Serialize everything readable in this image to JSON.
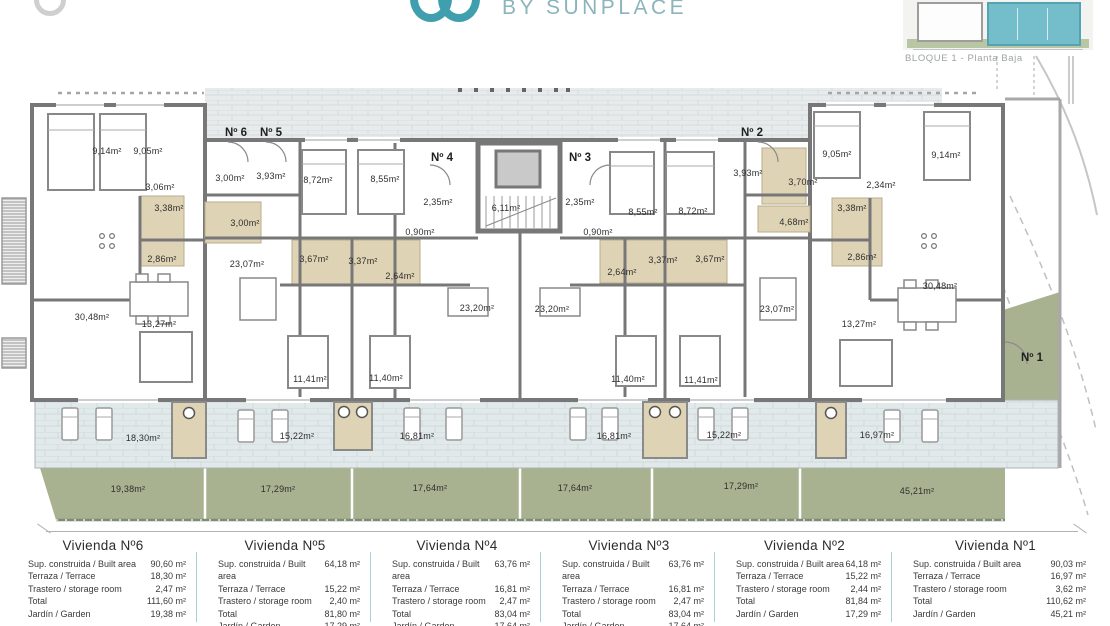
{
  "header": {
    "brand": "BY SUNPLACE",
    "caption": "BLOQUE 1 - Planta Baja"
  },
  "colors": {
    "accent_teal": "#3f9fae",
    "brand_text": "#8cb4bc",
    "wall_gray": "#777777",
    "bath_tan": "#ded3b4",
    "terrace_blue_gray": "#e2e9ea",
    "garden_green": "#a8b290",
    "table_separator": "#a9d2d6"
  },
  "plan": {
    "entrances": [
      {
        "t": "Nº 6",
        "x": 236,
        "y": 133
      },
      {
        "t": "Nº 5",
        "x": 271,
        "y": 133
      },
      {
        "t": "Nº 4",
        "x": 442,
        "y": 158
      },
      {
        "t": "Nº 3",
        "x": 580,
        "y": 158
      },
      {
        "t": "Nº 2",
        "x": 752,
        "y": 133
      },
      {
        "t": "Nº 1",
        "x": 1032,
        "y": 358
      }
    ],
    "rooms": [
      {
        "t": "9,14m²",
        "x": 107,
        "y": 151
      },
      {
        "t": "9,05m²",
        "x": 148,
        "y": 151
      },
      {
        "t": "3,06m²",
        "x": 160,
        "y": 187
      },
      {
        "t": "3,00m²",
        "x": 230,
        "y": 178
      },
      {
        "t": "3,93m²",
        "x": 271,
        "y": 176
      },
      {
        "t": "3,38m²",
        "x": 169,
        "y": 208
      },
      {
        "t": "3,00m²",
        "x": 245,
        "y": 223
      },
      {
        "t": "2,86m²",
        "x": 162,
        "y": 259
      },
      {
        "t": "23,07m²",
        "x": 247,
        "y": 264
      },
      {
        "t": "30,48m²",
        "x": 92,
        "y": 317
      },
      {
        "t": "13,27m²",
        "x": 159,
        "y": 324
      },
      {
        "t": "8,72m²",
        "x": 318,
        "y": 180
      },
      {
        "t": "8,55m²",
        "x": 385,
        "y": 179
      },
      {
        "t": "2,35m²",
        "x": 438,
        "y": 202
      },
      {
        "t": "6,11m²",
        "x": 506,
        "y": 208
      },
      {
        "t": "0,90m²",
        "x": 420,
        "y": 232
      },
      {
        "t": "3,67m²",
        "x": 314,
        "y": 259
      },
      {
        "t": "3,37m²",
        "x": 363,
        "y": 261
      },
      {
        "t": "2,64m²",
        "x": 400,
        "y": 276
      },
      {
        "t": "23,20m²",
        "x": 477,
        "y": 308
      },
      {
        "t": "23,20m²",
        "x": 552,
        "y": 309
      },
      {
        "t": "2,35m²",
        "x": 580,
        "y": 202
      },
      {
        "t": "0,90m²",
        "x": 598,
        "y": 232
      },
      {
        "t": "8,55m²",
        "x": 643,
        "y": 212
      },
      {
        "t": "8,72m²",
        "x": 693,
        "y": 211
      },
      {
        "t": "3,93m²",
        "x": 748,
        "y": 173
      },
      {
        "t": "3,70m²",
        "x": 803,
        "y": 182
      },
      {
        "t": "4,68m²",
        "x": 794,
        "y": 222
      },
      {
        "t": "2,64m²",
        "x": 622,
        "y": 272
      },
      {
        "t": "3,37m²",
        "x": 663,
        "y": 260
      },
      {
        "t": "3,67m²",
        "x": 710,
        "y": 259
      },
      {
        "t": "23,07m²",
        "x": 777,
        "y": 309
      },
      {
        "t": "13,27m²",
        "x": 859,
        "y": 324
      },
      {
        "t": "9,05m²",
        "x": 837,
        "y": 154
      },
      {
        "t": "9,14m²",
        "x": 946,
        "y": 155
      },
      {
        "t": "2,34m²",
        "x": 881,
        "y": 185
      },
      {
        "t": "3,38m²",
        "x": 852,
        "y": 208
      },
      {
        "t": "2,86m²",
        "x": 862,
        "y": 257
      },
      {
        "t": "30,48m²",
        "x": 940,
        "y": 286
      },
      {
        "t": "11,41m²",
        "x": 310,
        "y": 379
      },
      {
        "t": "11,40m²",
        "x": 386,
        "y": 378
      },
      {
        "t": "11,40m²",
        "x": 628,
        "y": 379
      },
      {
        "t": "11,41m²",
        "x": 701,
        "y": 380
      },
      {
        "t": "18,30m²",
        "x": 143,
        "y": 438
      },
      {
        "t": "15,22m²",
        "x": 297,
        "y": 436
      },
      {
        "t": "16,81m²",
        "x": 417,
        "y": 436
      },
      {
        "t": "16,81m²",
        "x": 614,
        "y": 436
      },
      {
        "t": "15,22m²",
        "x": 724,
        "y": 435
      },
      {
        "t": "16,97m²",
        "x": 877,
        "y": 435
      },
      {
        "t": "19,38m²",
        "x": 128,
        "y": 489
      },
      {
        "t": "17,29m²",
        "x": 278,
        "y": 489
      },
      {
        "t": "17,64m²",
        "x": 430,
        "y": 488
      },
      {
        "t": "17,64m²",
        "x": 575,
        "y": 488
      },
      {
        "t": "17,29m²",
        "x": 741,
        "y": 486
      },
      {
        "t": "45,21m²",
        "x": 917,
        "y": 491
      }
    ]
  },
  "table": {
    "units": [
      {
        "title": "Vivienda Nº6",
        "rows": [
          {
            "label": "Sup. construida / Built area",
            "value": "90,60 m²"
          },
          {
            "label": "Terraza / Terrace",
            "value": "18,30 m²"
          },
          {
            "label": "Trastero / storage room",
            "value": "2,47 m²"
          },
          {
            "label": "Total",
            "value": "111,60 m²"
          },
          {
            "label": "Jardín / Garden",
            "value": "19,38 m²"
          }
        ]
      },
      {
        "title": "Vivienda Nº5",
        "rows": [
          {
            "label": "Sup. construida / Built area",
            "value": "64,18 m²"
          },
          {
            "label": "Terraza / Terrace",
            "value": "15,22 m²"
          },
          {
            "label": "Trastero / storage room",
            "value": "2,40 m²"
          },
          {
            "label": "Total",
            "value": "81,80 m²"
          },
          {
            "label": "Jardín / Garden",
            "value": "17,29 m²"
          }
        ]
      },
      {
        "title": "Vivienda Nº4",
        "rows": [
          {
            "label": "Sup. construida / Built area",
            "value": "63,76 m²"
          },
          {
            "label": "Terraza / Terrace",
            "value": "16,81 m²"
          },
          {
            "label": "Trastero / storage room",
            "value": "2,47 m²"
          },
          {
            "label": "Total",
            "value": "83,04 m²"
          },
          {
            "label": "Jardín / Garden",
            "value": "17,64 m²"
          }
        ]
      },
      {
        "title": "Vivienda Nº3",
        "rows": [
          {
            "label": "Sup. construida / Built area",
            "value": "63,76 m²"
          },
          {
            "label": "Terraza / Terrace",
            "value": "16,81 m²"
          },
          {
            "label": "Trastero / storage room",
            "value": "2,47 m²"
          },
          {
            "label": "Total",
            "value": "83,04 m²"
          },
          {
            "label": "Jardín / Garden",
            "value": "17,64 m²"
          }
        ]
      },
      {
        "title": "Vivienda Nº2",
        "rows": [
          {
            "label": "Sup. construida / Built area",
            "value": "64,18 m²"
          },
          {
            "label": "Terraza / Terrace",
            "value": "15,22 m²"
          },
          {
            "label": "Trastero / storage room",
            "value": "2,44 m²"
          },
          {
            "label": "Total",
            "value": "81,84 m²"
          },
          {
            "label": "Jardín / Garden",
            "value": "17,29 m²"
          }
        ]
      },
      {
        "title": "Vivienda Nº1",
        "rows": [
          {
            "label": "Sup. construida / Built area",
            "value": "90,03 m²"
          },
          {
            "label": "Terraza / Terrace",
            "value": "16,97 m²"
          },
          {
            "label": "Trastero / storage room",
            "value": "3,62 m²"
          },
          {
            "label": "Total",
            "value": "110,62 m²"
          },
          {
            "label": "Jardín / Garden",
            "value": "45,21 m²"
          }
        ]
      }
    ]
  }
}
